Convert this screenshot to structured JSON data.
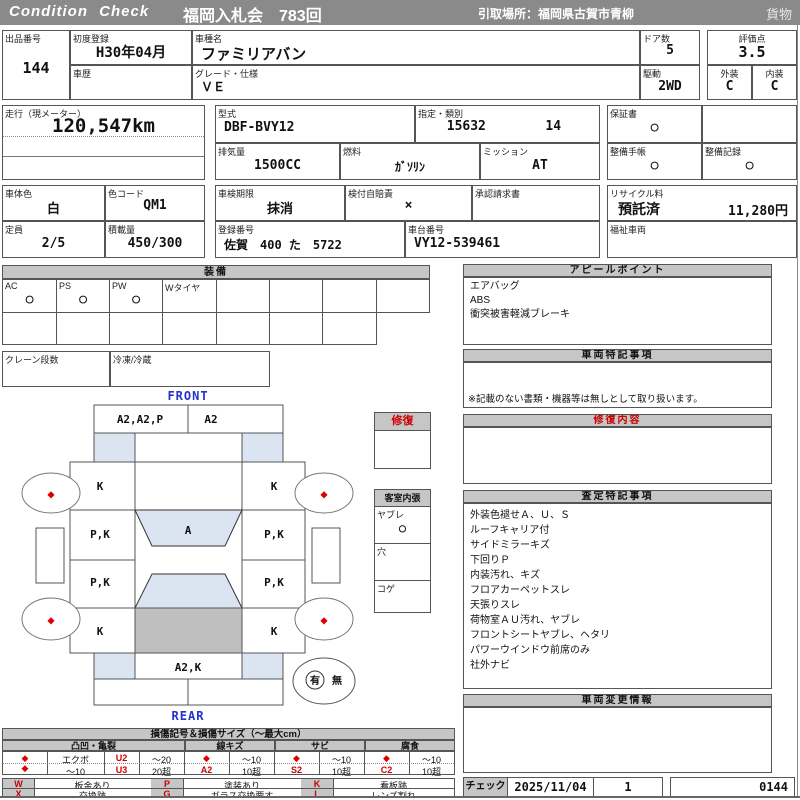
{
  "header": {
    "logo": "Condition  Check",
    "auction_title": "福岡入札会　783回",
    "pickup_location": "引取場所：福岡県古賀市青柳",
    "category": "貨物"
  },
  "info": {
    "lot": {
      "label": "出品番号",
      "value": "144"
    },
    "first_reg": {
      "label": "初度登録",
      "value": "H30年04月"
    },
    "history": {
      "label": "車歴",
      "value": ""
    },
    "model_name": {
      "label": "車種名",
      "value": "ファミリアバン"
    },
    "grade": {
      "label": "グレード・仕様",
      "value": "ＶＥ"
    },
    "doors": {
      "label": "ドア数",
      "value": "5"
    },
    "drive": {
      "label": "駆動",
      "value": "2WD"
    },
    "score": {
      "label": "評価点",
      "value": "3.5"
    },
    "exterior": {
      "label": "外装",
      "value": "C"
    },
    "interior": {
      "label": "内装",
      "value": "C"
    },
    "mileage": {
      "label": "走行（現メーター）",
      "value": "120,547km"
    },
    "model_code": {
      "label": "型式",
      "value": "DBF-BVY12"
    },
    "type_class": {
      "label": "指定・類別",
      "type": "15632",
      "class": "14"
    },
    "displacement": {
      "label": "排気量",
      "value": "1500CC"
    },
    "fuel": {
      "label": "燃料",
      "value": "ｶﾞｿﾘﾝ"
    },
    "mission": {
      "label": "ミッション",
      "value": "AT"
    },
    "warranty": {
      "label": "保証書",
      "value": "○"
    },
    "maintenance_book": {
      "label": "整備手帳",
      "value": "○"
    },
    "maintenance_record": {
      "label": "整備記録",
      "value": "○"
    },
    "body_color": {
      "label": "車体色",
      "value": "白"
    },
    "color_code": {
      "label": "色コード",
      "value": "QM1"
    },
    "inspection": {
      "label": "車検期限",
      "value": "抹消"
    },
    "insurance": {
      "label": "検付自賠責",
      "value": "×"
    },
    "approval": {
      "label": "承認請求書",
      "value": ""
    },
    "recycle": {
      "label": "リサイクル料",
      "status": "預託済",
      "fee": "11,280円"
    },
    "capacity": {
      "label": "定員",
      "value": "2/5"
    },
    "load": {
      "label": "積載量",
      "value": "450/300"
    },
    "reg_no": {
      "label": "登録番号",
      "value": "佐賀　400 た　5722"
    },
    "chassis": {
      "label": "車台番号",
      "value": "VY12-539461"
    },
    "welfare": {
      "label": "福祉車両",
      "value": ""
    }
  },
  "equipment": {
    "title": "装備",
    "cells": [
      {
        "label": "AC",
        "value": "○"
      },
      {
        "label": "PS",
        "value": "○"
      },
      {
        "label": "PW",
        "value": "○"
      },
      {
        "label": "Wタイヤ",
        "value": ""
      },
      {
        "label": "",
        "value": ""
      },
      {
        "label": "",
        "value": ""
      },
      {
        "label": "",
        "value": ""
      },
      {
        "label": "",
        "value": ""
      }
    ],
    "crane": {
      "label": "クレーン段数",
      "value": ""
    },
    "fridge": {
      "label": "冷凍/冷蔵",
      "value": ""
    }
  },
  "diagram": {
    "front_label": "FRONT",
    "rear_label": "REAR",
    "tire_mark_icon": "◆",
    "panels": {
      "front_bumper_l": "A2,A2,P",
      "front_bumper_r": "A2",
      "fender_fl": "K",
      "fender_fr": "K",
      "door_fl": "P,K",
      "door_fr": "P,K",
      "door_rl": "P,K",
      "door_rr": "P,K",
      "quarter_rl": "K",
      "quarter_rr": "K",
      "windshield": "A",
      "back_panel": "A2,K"
    },
    "presence": {
      "yes": "有",
      "no": "無"
    },
    "repair_box": {
      "title": "修復"
    },
    "cabin_box": {
      "title": "客室内張",
      "items": [
        {
          "label": "ヤブレ",
          "value": "○"
        },
        {
          "label": "穴",
          "value": ""
        },
        {
          "label": "コゲ",
          "value": ""
        }
      ]
    }
  },
  "appeal": {
    "title": "アピールポイント",
    "lines": [
      "エアバッグ",
      "ABS",
      "衝突被害軽減ブレーキ"
    ]
  },
  "vehicle_notes": {
    "title": "車両特記事項",
    "footnote": "※記載のない書類・機器等は無しとして取り扱います。"
  },
  "repair_content": {
    "title": "修復内容"
  },
  "assessment": {
    "title": "査定特記事項",
    "lines": [
      "外装色褪せＡ、Ｕ、Ｓ",
      "ルーフキャリア付",
      "サイドミラーキズ",
      "下回りＰ",
      "内装汚れ、キズ",
      "フロアカーペットスレ",
      "天張りスレ",
      "荷物室ＡＵ汚れ、ヤブレ",
      "フロントシートヤブレ、ヘタリ",
      "パワーウインドウ前席のみ",
      "社外ナビ"
    ]
  },
  "change_info": {
    "title": "車両変更情報"
  },
  "damage_legend": {
    "title": "損傷記号＆損傷サイズ（〜最大cm）",
    "diamond_icon": "◆",
    "groups": {
      "dent": "凸凹・亀裂",
      "scratch": "線キズ",
      "rust": "サビ",
      "corrosion": "腐食"
    },
    "dent": {
      "r1_name": "エクボ",
      "r1_code": "U2",
      "r1_size": "〜20",
      "r2_name": "〜10",
      "r2_code": "U3",
      "r2_size": "20超"
    },
    "scratch": {
      "r1_size": "〜10",
      "r2_code": "A2",
      "r2_size": "10超"
    },
    "rust": {
      "r1_size": "〜10",
      "r2_code": "S2",
      "r2_size": "10超"
    },
    "corrosion": {
      "r1_size": "〜10",
      "r2_code": "C2",
      "r2_size": "10超"
    },
    "codes": [
      {
        "key": "W",
        "label": "板金あり"
      },
      {
        "key": "P",
        "label": "塗装あり"
      },
      {
        "key": "K",
        "label": "看板跡"
      },
      {
        "key": "X",
        "label": "交換跡"
      },
      {
        "key": "G",
        "label": "ガラス交換要す"
      },
      {
        "key": "L",
        "label": "レンズ割れ"
      }
    ]
  },
  "check": {
    "label": "チェック",
    "date": "2025/11/04",
    "count": "1",
    "sheet_no": "0144"
  },
  "colors": {
    "titlebar": "#8a8a8a",
    "section_header": "#c6c6c6",
    "panel_blue": "#dbe5f1",
    "cargo_gray": "#bfbfbf",
    "mark_red": "#dd0000",
    "label_blue": "#2233cc",
    "repair_red": "#cc0000"
  }
}
